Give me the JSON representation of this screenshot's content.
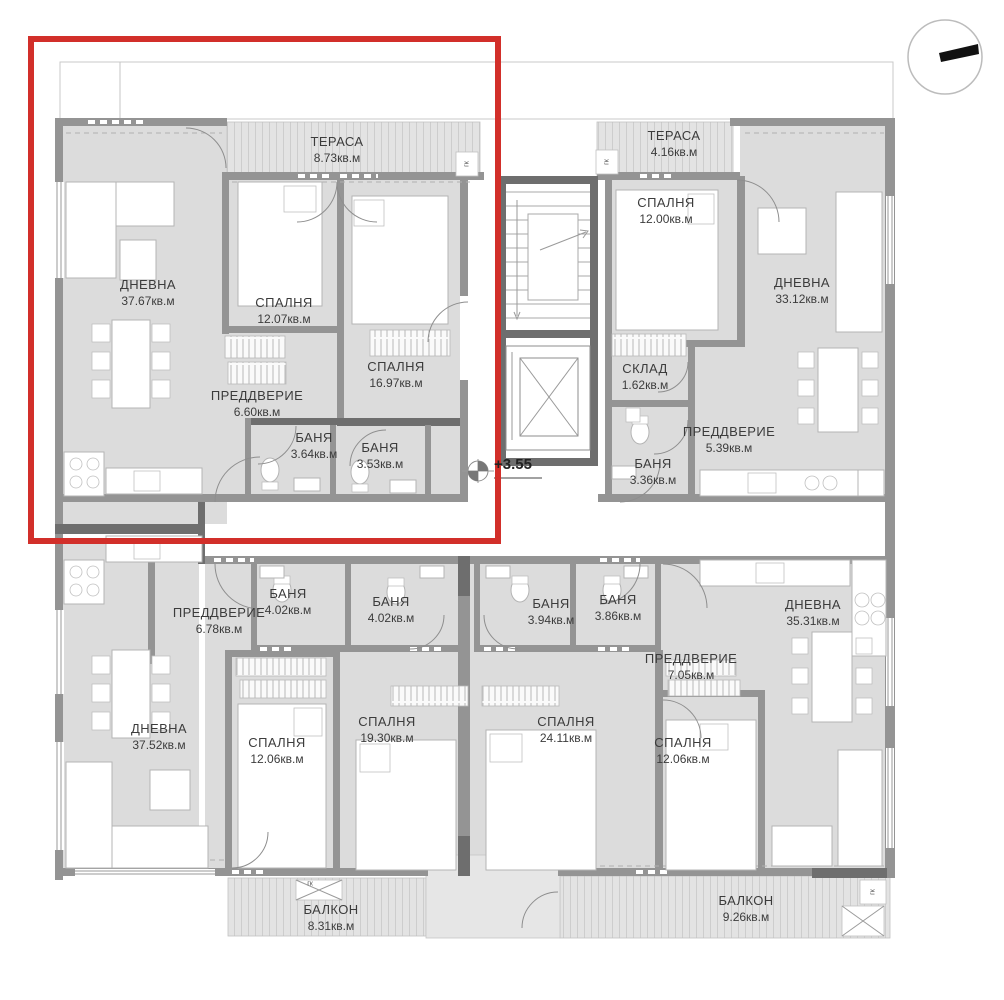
{
  "plan": {
    "type": "apartment-floor-plan",
    "level_marker": "+3.55",
    "area_unit": "кв.м"
  },
  "colors": {
    "highlight_red": "#d22f2a",
    "wall_gray": "#949494",
    "wall_dark": "#6e6e6e",
    "room_fill": "#dcdcdc",
    "terrace_fill": "#e3e3e3"
  },
  "icons": {
    "compass": "north-arrow-icon"
  },
  "annotations": {
    "level": "+3.55",
    "gk": "гк"
  },
  "apartments": [
    {
      "id": "top-left-highlighted",
      "highlighted": true,
      "rooms": [
        {
          "name": "ТЕРАСА",
          "area": "8.73кв.м"
        },
        {
          "name": "ДНЕВНА",
          "area": "37.67кв.м"
        },
        {
          "name": "СПАЛНЯ",
          "area": "12.07кв.м"
        },
        {
          "name": "СПАЛНЯ",
          "area": "16.97кв.м"
        },
        {
          "name": "ПРЕДДВЕРИЕ",
          "area": "6.60кв.м"
        },
        {
          "name": "БАНЯ",
          "area": "3.64кв.м"
        },
        {
          "name": "БАНЯ",
          "area": "3.53кв.м"
        }
      ]
    },
    {
      "id": "top-right",
      "highlighted": false,
      "rooms": [
        {
          "name": "ТЕРАСА",
          "area": "4.16кв.м"
        },
        {
          "name": "СПАЛНЯ",
          "area": "12.00кв.м"
        },
        {
          "name": "ДНЕВНА",
          "area": "33.12кв.м"
        },
        {
          "name": "СКЛАД",
          "area": "1.62кв.м"
        },
        {
          "name": "ПРЕДДВЕРИЕ",
          "area": "5.39кв.м"
        },
        {
          "name": "БАНЯ",
          "area": "3.36кв.м"
        }
      ]
    },
    {
      "id": "bottom-left",
      "highlighted": false,
      "rooms": [
        {
          "name": "ПРЕДДВЕРИЕ",
          "area": "6.78кв.м"
        },
        {
          "name": "БАНЯ",
          "area": "4.02кв.м"
        },
        {
          "name": "БАНЯ",
          "area": "4.02кв.м"
        },
        {
          "name": "ДНЕВНА",
          "area": "37.52кв.м"
        },
        {
          "name": "СПАЛНЯ",
          "area": "12.06кв.м"
        },
        {
          "name": "СПАЛНЯ",
          "area": "19.30кв.м"
        },
        {
          "name": "БАЛКОН",
          "area": "8.31кв.м"
        }
      ]
    },
    {
      "id": "bottom-right",
      "highlighted": false,
      "rooms": [
        {
          "name": "БАНЯ",
          "area": "3.94кв.м"
        },
        {
          "name": "БАНЯ",
          "area": "3.86кв.м"
        },
        {
          "name": "СПАЛНЯ",
          "area": "24.11кв.м"
        },
        {
          "name": "ПРЕДДВЕРИЕ",
          "area": "7.05кв.м"
        },
        {
          "name": "СПАЛНЯ",
          "area": "12.06кв.м"
        },
        {
          "name": "ДНЕВНА",
          "area": "35.31кв.м"
        },
        {
          "name": "БАЛКОН",
          "area": "9.26кв.м"
        }
      ]
    }
  ]
}
